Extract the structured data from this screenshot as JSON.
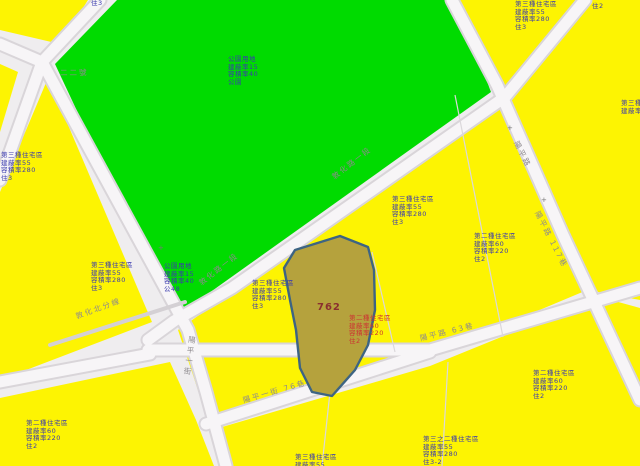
{
  "map": {
    "colors": {
      "bg": "#efedef",
      "zone_yellow": "#fdf402",
      "park_green": "#00db00",
      "road_fill": "#f7f5f7",
      "road_casing": "#d9d5d9",
      "canal_gray": "#d4d0d4",
      "parcel_line": "#dbd8db",
      "selected_parcel_fill": "#b5a23d",
      "selected_parcel_border": "#3d6483",
      "zone_text_blue": "#3a3aae",
      "zone_text_red": "#cc3333",
      "parcel_number_color": "#8a2f2f",
      "road_label_gray": "#8d898d"
    },
    "selected_parcel": "762",
    "zone_labels": [
      {
        "name": "park-label-center",
        "x": 228,
        "y": 56,
        "style": "",
        "lines": [
          "公園用地",
          "建蔽率15",
          "容積率40",
          "公園"
        ]
      },
      {
        "name": "park-label-sw",
        "x": 164,
        "y": 263,
        "style": "",
        "lines": [
          "公園用地",
          "建蔽率15",
          "容積率40",
          "公48"
        ]
      },
      {
        "name": "zone-label-left-mid",
        "x": 91,
        "y": 262,
        "style": "",
        "lines": [
          "第三種住宅區",
          "建蔽率55",
          "容積率280",
          "住3"
        ]
      },
      {
        "name": "zone-label-bottom-left",
        "x": 26,
        "y": 420,
        "style": "",
        "lines": [
          "第二種住宅區",
          "建蔽率60",
          "容積率220",
          "住2"
        ]
      },
      {
        "name": "zone-label-center-west",
        "x": 252,
        "y": 280,
        "style": "",
        "lines": [
          "第三種住宅區",
          "建蔽率55",
          "容積率280",
          "住3"
        ]
      },
      {
        "name": "zone-label-in-parcel",
        "x": 349,
        "y": 315,
        "style": "red",
        "lines": [
          "第二種住宅區",
          "建蔽率60",
          "容積率220",
          "住2"
        ]
      },
      {
        "name": "zone-label-center-north",
        "x": 392,
        "y": 196,
        "style": "",
        "lines": [
          "第三種住宅區",
          "建蔽率55",
          "容積率280",
          "住3"
        ]
      },
      {
        "name": "zone-label-center-east",
        "x": 474,
        "y": 233,
        "style": "",
        "lines": [
          "第二種住宅區",
          "建蔽率60",
          "容積率220",
          "住2"
        ]
      },
      {
        "name": "zone-label-top-right-a",
        "x": 515,
        "y": 1,
        "style": "",
        "lines": [
          "第三種住宅區",
          "建蔽率55",
          "容積率280",
          "住3"
        ]
      },
      {
        "name": "zone-label-top-right-b",
        "x": 592,
        "y": 3,
        "style": "",
        "lines": [
          "住2"
        ]
      },
      {
        "name": "zone-label-bottom-right",
        "x": 533,
        "y": 370,
        "style": "",
        "lines": [
          "第二種住宅區",
          "建蔽率60",
          "容積率220",
          "住2"
        ]
      },
      {
        "name": "zone-label-bottom-center",
        "x": 423,
        "y": 436,
        "style": "",
        "lines": [
          "第三之二種住宅區",
          "建蔽率55",
          "容積率280",
          "住3-2"
        ]
      },
      {
        "name": "zone-label-bottom-edge-cut",
        "x": 295,
        "y": 454,
        "style": "",
        "lines": [
          "第三種住宅區",
          "建蔽率55"
        ]
      },
      {
        "name": "zone-label-right-edge-cut",
        "x": 621,
        "y": 100,
        "style": "",
        "lines": [
          "第三種住宅區",
          "建蔽率55"
        ]
      },
      {
        "name": "zone-label-left-edge-cut",
        "x": 1,
        "y": 152,
        "style": "",
        "lines": [
          "第三種住宅區",
          "建蔽率55",
          "容積率280",
          "住3"
        ]
      },
      {
        "name": "zone-label-top-left",
        "x": 91,
        "y": 0,
        "style": "",
        "lines": [
          "住3"
        ]
      },
      {
        "name": "parcel-number-label",
        "x": 317,
        "y": 304,
        "style": "parcel",
        "lines": [
          "762"
        ]
      }
    ],
    "road_labels": [
      {
        "text": "敦化路一段",
        "x": 333,
        "y": 172,
        "rot": -38
      },
      {
        "text": "敦化路一段",
        "x": 200,
        "y": 278,
        "rot": -38
      },
      {
        "text": "陽平路",
        "x": 516,
        "y": 136,
        "rot": 63
      },
      {
        "text": "陽平路 117巷",
        "x": 537,
        "y": 206,
        "rot": 63
      },
      {
        "text": "陽平路 63巷",
        "x": 420,
        "y": 333,
        "rot": -14
      },
      {
        "text": "陽平一街 76巷",
        "x": 243,
        "y": 395,
        "rot": -16
      },
      {
        "text": "陽平一街",
        "x": 187,
        "y": 336,
        "rot": 8,
        "vertical": true
      },
      {
        "text": "敦化北分線",
        "x": 76,
        "y": 311,
        "rot": -20
      },
      {
        "text": "二二號",
        "x": 60,
        "y": 67,
        "rot": 0
      }
    ],
    "markers": [
      {
        "glyph": "+",
        "x": 158,
        "y": 245
      },
      {
        "glyph": "+",
        "x": 507,
        "y": 125
      },
      {
        "glyph": "+",
        "x": 541,
        "y": 197
      }
    ]
  }
}
